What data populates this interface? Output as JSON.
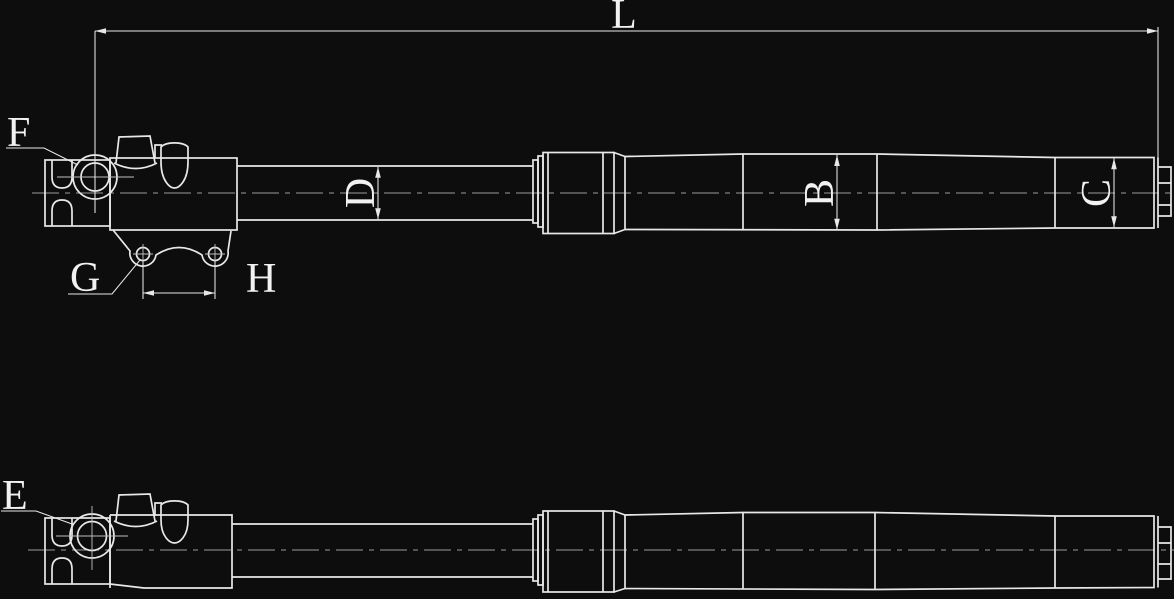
{
  "colors": {
    "background": "#0d0d0d",
    "line": "#e8e8e8",
    "centerline": "#9a9a9a",
    "crosshair": "#c0c0c0",
    "text": "#f2f2f2"
  },
  "labels": {
    "overall_length": "L",
    "eye_callout_top": "F",
    "bracket_hole_callout": "G",
    "bracket_hole_spacing": "H",
    "rod_diameter": "D",
    "tube_diameter": "B",
    "end_cap_diameter": "C",
    "eye_callout_side": "E"
  }
}
